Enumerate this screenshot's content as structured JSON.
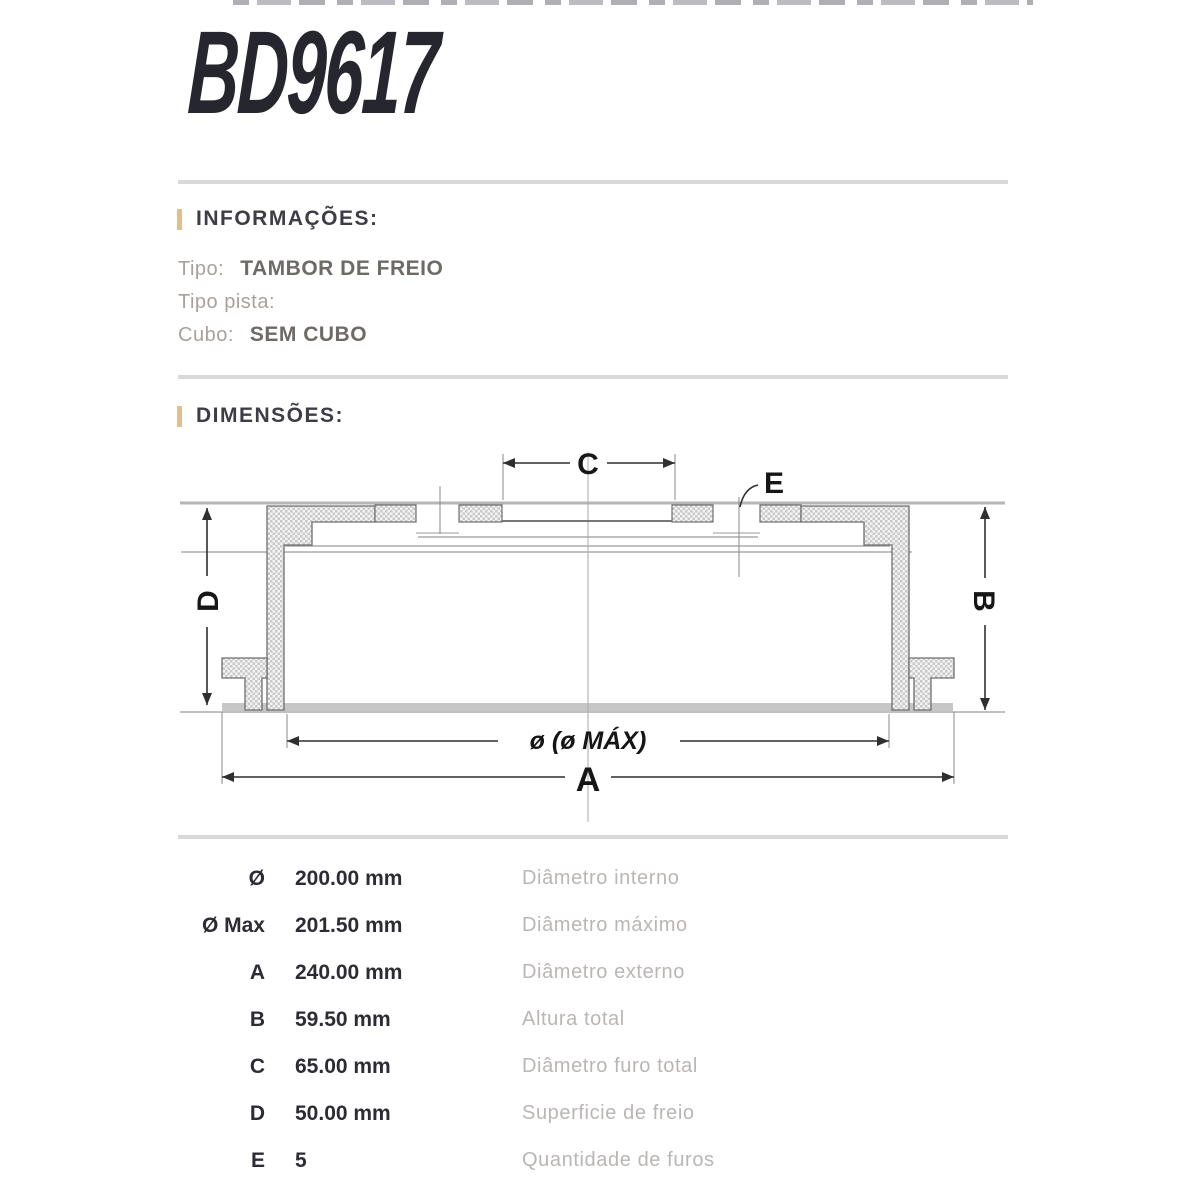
{
  "title": {
    "part_number": "BD9617"
  },
  "info_section": {
    "heading": "INFORMAÇÕES:",
    "rows": [
      {
        "label": "Tipo:",
        "value": "TAMBOR DE FREIO"
      },
      {
        "label": "Tipo pista:",
        "value": ""
      },
      {
        "label": "Cubo:",
        "value": "SEM CUBO"
      }
    ]
  },
  "dimensions_section": {
    "heading": "DIMENSÕES:",
    "diagram": {
      "labels": {
        "c": "C",
        "e": "E",
        "d": "D",
        "b": "B",
        "diameter": "ø (ø MÁX)",
        "a": "A"
      }
    },
    "table": {
      "rows": [
        {
          "symbol": "Ø",
          "value": "200.00 mm",
          "description": "Diâmetro interno"
        },
        {
          "symbol": "Ø Max",
          "value": "201.50 mm",
          "description": "Diâmetro máximo"
        },
        {
          "symbol": "A",
          "value": "240.00 mm",
          "description": "Diâmetro externo"
        },
        {
          "symbol": "B",
          "value": "59.50 mm",
          "description": "Altura total"
        },
        {
          "symbol": "C",
          "value": "65.00 mm",
          "description": "Diâmetro furo total"
        },
        {
          "symbol": "D",
          "value": "50.00 mm",
          "description": "Superficie de freio"
        },
        {
          "symbol": "E",
          "value": "5",
          "description": "Quantidade de furos"
        }
      ]
    }
  },
  "colors": {
    "accent_bar": "#dcc094",
    "heading_text": "#3e3d47",
    "divider": "#d9d9d9",
    "title_text": "#26262e",
    "value_text": "#2c2c34",
    "muted_text": "#b9b6b3"
  }
}
